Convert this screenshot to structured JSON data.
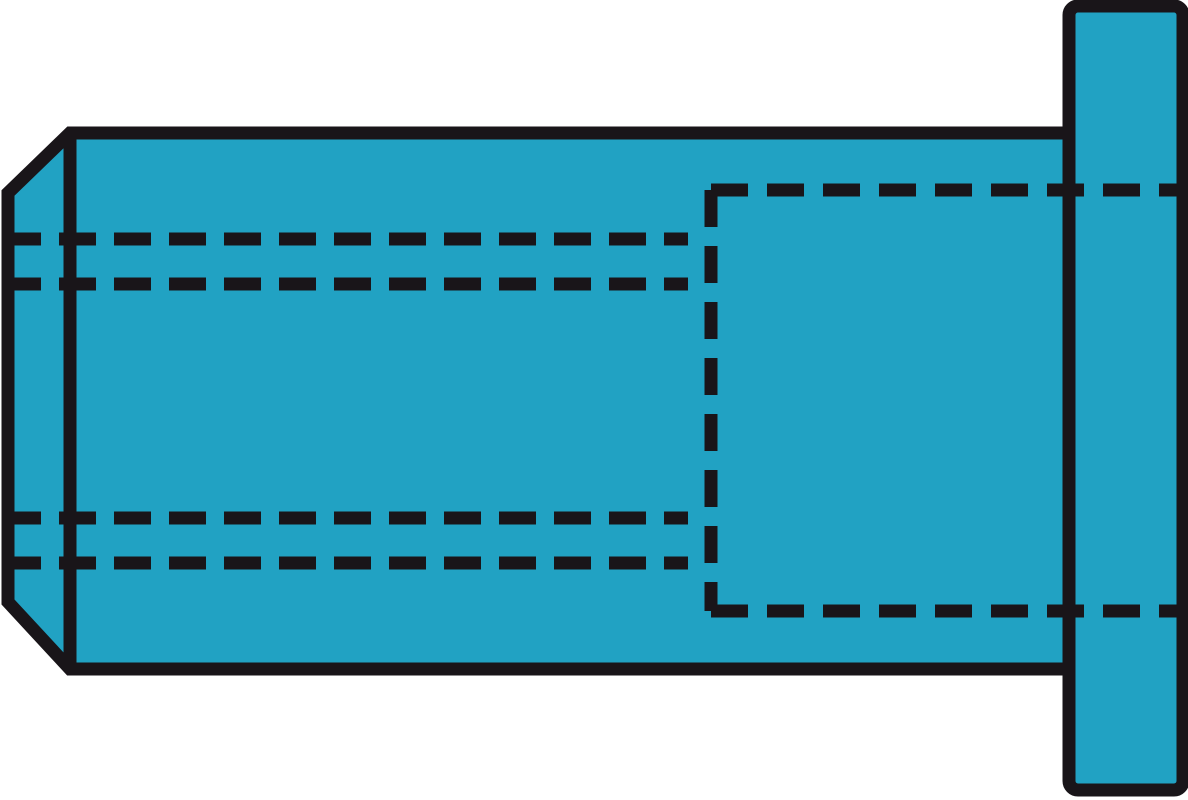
{
  "figure": {
    "kind": "technical-part-illustration",
    "subject": "blind-rivet-nut-flat-head-side-view",
    "parts": {
      "body": "rivet-nut-shank-body",
      "shoulder": "chamfer-shoulder-edge",
      "flange": "flange-head",
      "thread_lines": "internal-thread-hidden-lines",
      "bore_lines": "internal-bore-hidden-lines"
    }
  },
  "colors": {
    "background": "#ffffff",
    "part_fill": "#21a2c3",
    "line": "#191519"
  }
}
